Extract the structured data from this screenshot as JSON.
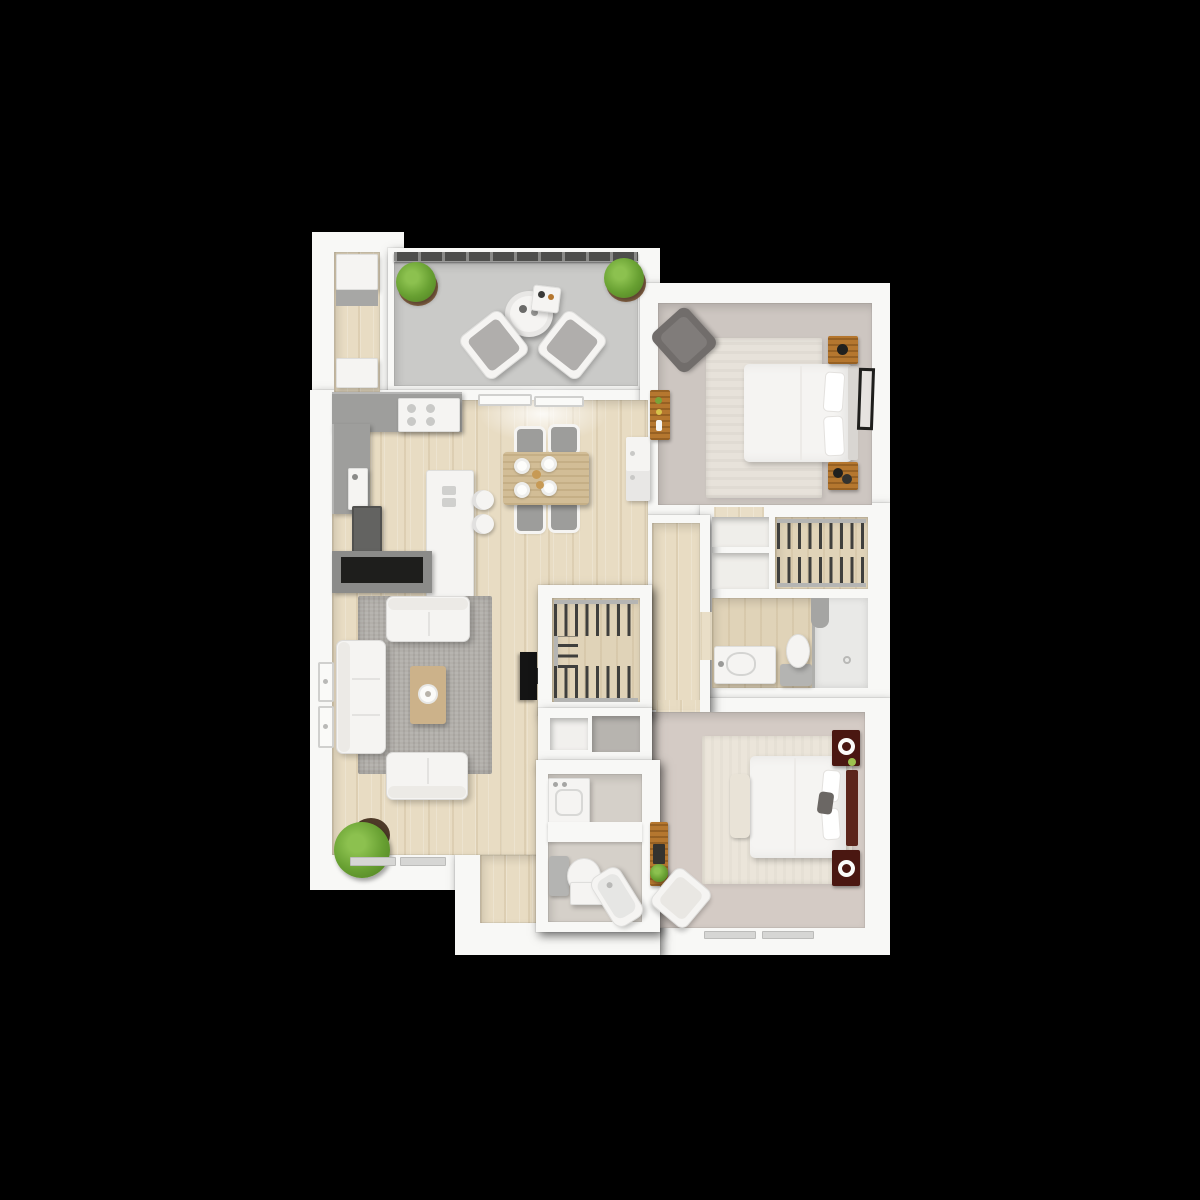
{
  "meta": {
    "description": "3D top-down rendering of a two-bedroom two-bathroom apartment floor plan with balcony, on a black background",
    "background": "#000000"
  },
  "palette": {
    "background": "#000000",
    "wall": "#f8f8f6",
    "wood_floor": "#e8dcc3",
    "closet_floor": "#e0d3b8",
    "balcony_floor": "#cacac8",
    "bedroom1_floor": "#cdc6c1",
    "bedroom2_floor": "#d4cbc5",
    "bath2_floor": "#d5d0c9",
    "rug_living": "#b2afaa",
    "rug_bedroom1": "#e7e2da",
    "rug_bedroom2": "#ebe5da",
    "counter": "#9e9e9c",
    "appliance_dark": "#636361",
    "console_gray": "#8b8b89",
    "console_screen": "#1e1e1c",
    "sofa_white": "#f5f4f2",
    "coffee_table": "#ccb28a",
    "dining_table": "#d2bd96",
    "chair_gray": "#9d9d9b",
    "plant_green": "#68a032",
    "plant_pot": "#8a6647",
    "nightstand_wood": "#b5772f",
    "nightstand_dark": "#4a1711",
    "headboard2": "#5b251b",
    "tv_black": "#141414",
    "clothes_dark": "#3f3f3d",
    "rod_gray": "#b5b5b3",
    "railing_dark": "#4e4e4c",
    "fixture_white": "#fafaf8",
    "fixture_gray": "#b4b4b2"
  },
  "rooms": [
    {
      "id": "balcony",
      "label": "Balcony",
      "furniture": [
        "railing",
        "potted-plant",
        "potted-plant",
        "round-patio-table",
        "tray-side-table",
        "lounge-chair",
        "lounge-chair"
      ]
    },
    {
      "id": "utility-closet",
      "label": "Utility Closet",
      "furniture": [
        "stacked-appliance",
        "counter",
        "lower-cabinet"
      ]
    },
    {
      "id": "kitchen",
      "label": "Kitchen",
      "furniture": [
        "l-shaped-counter",
        "cooktop",
        "sink",
        "refrigerator-dark",
        "island-peninsula",
        "bar-stool",
        "bar-stool"
      ]
    },
    {
      "id": "dining",
      "label": "Dining Area",
      "furniture": [
        "wood-dining-table",
        "dining-chair",
        "dining-chair",
        "dining-chair",
        "dining-chair",
        "place-setting",
        "place-setting",
        "place-setting",
        "place-setting",
        "tall-white-cabinet",
        "ceiling-light"
      ]
    },
    {
      "id": "living",
      "label": "Living Room",
      "furniture": [
        "sofa",
        "loveseat",
        "loveseat",
        "coffee-table",
        "round-tray",
        "area-rug",
        "media-console",
        "wall-mounted-tv",
        "floor-plant",
        "window",
        "window",
        "window-sill",
        "window-sill"
      ]
    },
    {
      "id": "bedroom-1",
      "label": "Bedroom 1",
      "furniture": [
        "bed",
        "pillow",
        "pillow",
        "nightstand",
        "nightstand",
        "area-rug",
        "accent-chair",
        "dresser",
        "wall-art-frame"
      ]
    },
    {
      "id": "closet-1",
      "label": "Bedroom 1 Closet",
      "furniture": [
        "hanging-clothes-rod",
        "hanging-clothes-rod"
      ]
    },
    {
      "id": "linen-closet",
      "label": "Linen Closet",
      "furniture": [
        "open-shelf",
        "open-shelf"
      ]
    },
    {
      "id": "bathroom-1",
      "label": "Bathroom 1",
      "furniture": [
        "vanity-sink",
        "toilet",
        "walk-in-shower"
      ]
    },
    {
      "id": "walk-in-closet",
      "label": "Walk-in Closet",
      "furniture": [
        "hanging-clothes-rod",
        "hanging-clothes-rod",
        "hanging-clothes-rod"
      ]
    },
    {
      "id": "hallway",
      "label": "Hallway",
      "furniture": [
        "open-niche",
        "open-niche"
      ]
    },
    {
      "id": "laundry",
      "label": "Laundry Nook",
      "furniture": [
        "washer-dryer-unit"
      ]
    },
    {
      "id": "bathroom-2",
      "label": "Bathroom 2",
      "furniture": [
        "toilet",
        "vanity",
        "bathtub"
      ]
    },
    {
      "id": "bedroom-2",
      "label": "Bedroom 2",
      "furniture": [
        "bed",
        "pillow",
        "pillow",
        "throw-pillow",
        "headboard",
        "nightstand",
        "nightstand",
        "table-lamp",
        "table-lamp",
        "foot-bench",
        "desk",
        "desk-chair",
        "small-plant",
        "area-rug",
        "window-sill",
        "window-sill"
      ]
    }
  ]
}
